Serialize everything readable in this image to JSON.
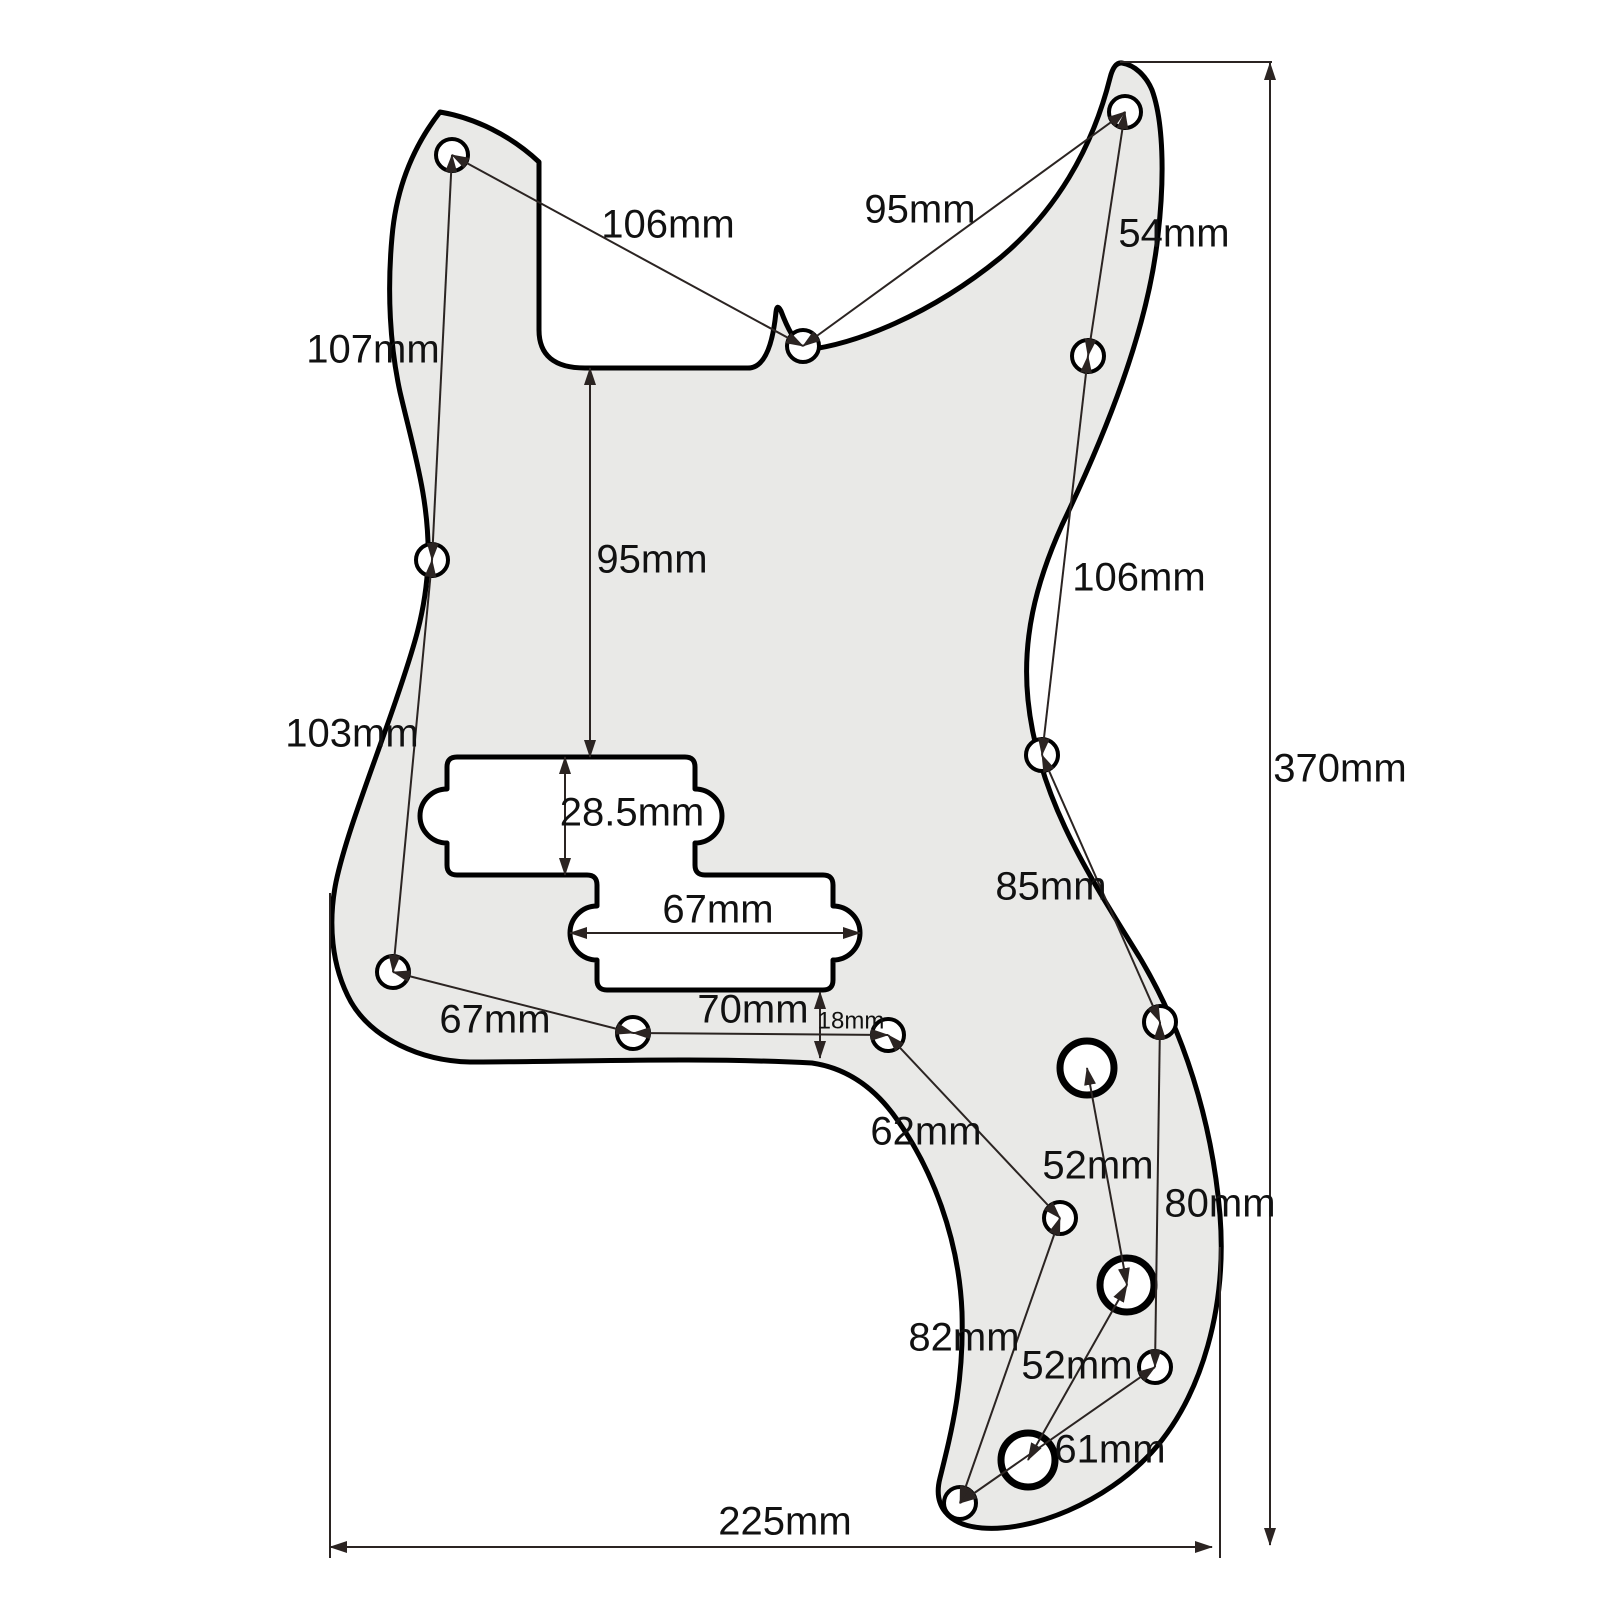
{
  "diagram": {
    "description": "P-Bass pickguard dimension drawing",
    "canvas": {
      "width": 1600,
      "height": 1600,
      "background": "#ffffff"
    },
    "colors": {
      "outline": "#000000",
      "pickguard_fill": "#e9e9e7",
      "cutout_fill": "#ffffff",
      "dimension_line": "#2b2422",
      "label_text": "#111111"
    },
    "pickguard_path": "M 440 112 C 475 118 510 135 539 162 L 539 330 Q 539 368 585 368 L 748 368 C 762 368 772 352 776 312 Q 777 303 781 311 C 787 327 794 342 806 350 C 856 344 930 315 1000 258 C 1055 212 1092 150 1110 78 Q 1114 62 1122 63 C 1135 65 1146 76 1152 90 C 1163 120 1165 175 1158 235 C 1148 330 1105 435 1062 525 C 1035 585 1022 640 1028 700 C 1038 800 1092 880 1140 958 C 1183 1030 1212 1120 1220 1215 C 1227 1305 1203 1395 1152 1452 C 1105 1503 1032 1532 982 1528 C 947 1525 933 1505 940 1478 C 952 1430 964 1382 962 1312 C 959 1240 933 1168 893 1114 C 872 1086 846 1068 812 1063 C 700 1057 565 1062 470 1062 C 420 1061 372 1038 351 1002 C 331 966 328 922 336 882 C 346 835 372 770 396 700 C 413 650 426 612 428 562 C 430 502 414 452 400 392 C 390 346 387 292 392 237 C 396 190 412 148 440 112 Z",
    "pickup_cutout_path": "M 457 757 L 685 757 Q 695 757 695 767 L 695 789 A 27 27 0 0 1 695 843 L 695 865 Q 695 875 705 875 L 823 875 Q 833 875 833 885 L 833 906 A 27 27 0 0 1 833 960 L 833 980 Q 833 990 823 990 L 607 990 Q 597 990 597 980 L 597 960 A 27 27 0 0 1 597 906 L 597 885 Q 597 875 587 875 L 457 875 Q 447 875 447 865 L 447 843 A 27 27 0 0 1 447 789 L 447 767 Q 447 757 457 757 Z",
    "screw_holes": [
      {
        "x": 452,
        "y": 155
      },
      {
        "x": 803,
        "y": 346
      },
      {
        "x": 1125,
        "y": 112
      },
      {
        "x": 1088,
        "y": 356
      },
      {
        "x": 432,
        "y": 560
      },
      {
        "x": 1042,
        "y": 755
      },
      {
        "x": 393,
        "y": 972
      },
      {
        "x": 633,
        "y": 1033
      },
      {
        "x": 888,
        "y": 1035
      },
      {
        "x": 1160,
        "y": 1022
      },
      {
        "x": 1060,
        "y": 1218
      },
      {
        "x": 1155,
        "y": 1367
      },
      {
        "x": 960,
        "y": 1503
      }
    ],
    "pot_holes": [
      {
        "x": 1087,
        "y": 1068
      },
      {
        "x": 1127,
        "y": 1285
      },
      {
        "x": 1028,
        "y": 1460
      }
    ],
    "extension_lines": [
      {
        "x1": 1120,
        "y1": 62,
        "x2": 1272,
        "y2": 62
      },
      {
        "x1": 330,
        "y1": 893,
        "x2": 330,
        "y2": 1558
      },
      {
        "x1": 1220,
        "y1": 1247,
        "x2": 1220,
        "y2": 1558
      }
    ],
    "dimensions": [
      {
        "label": "106mm",
        "x1": 452,
        "y1": 155,
        "x2": 803,
        "y2": 346,
        "lx": 668,
        "ly": 227,
        "size": 40
      },
      {
        "label": "95mm",
        "x1": 803,
        "y1": 346,
        "x2": 1125,
        "y2": 112,
        "lx": 920,
        "ly": 212,
        "size": 40
      },
      {
        "label": "54mm",
        "x1": 1125,
        "y1": 112,
        "x2": 1088,
        "y2": 356,
        "lx": 1174,
        "ly": 236,
        "size": 40
      },
      {
        "label": "107mm",
        "x1": 452,
        "y1": 155,
        "x2": 432,
        "y2": 560,
        "lx": 373,
        "ly": 352,
        "size": 40
      },
      {
        "label": "95mm",
        "x1": 590,
        "y1": 368,
        "x2": 590,
        "y2": 757,
        "lx": 652,
        "ly": 562,
        "size": 40
      },
      {
        "label": "106mm",
        "x1": 1088,
        "y1": 356,
        "x2": 1042,
        "y2": 755,
        "lx": 1139,
        "ly": 580,
        "size": 40
      },
      {
        "label": "103mm",
        "x1": 432,
        "y1": 560,
        "x2": 393,
        "y2": 972,
        "lx": 352,
        "ly": 736,
        "size": 40
      },
      {
        "label": "28.5mm",
        "x1": 565,
        "y1": 757,
        "x2": 565,
        "y2": 875,
        "lx": 632,
        "ly": 815,
        "size": 40
      },
      {
        "label": "67mm",
        "x1": 570,
        "y1": 933,
        "x2": 860,
        "y2": 933,
        "lx": 718,
        "ly": 912,
        "size": 40
      },
      {
        "label": "85mm",
        "x1": 1042,
        "y1": 755,
        "x2": 1160,
        "y2": 1022,
        "lx": 1051,
        "ly": 889,
        "size": 40
      },
      {
        "label": "67mm",
        "x1": 393,
        "y1": 972,
        "x2": 633,
        "y2": 1033,
        "lx": 495,
        "ly": 1022,
        "size": 40
      },
      {
        "label": "70mm",
        "x1": 633,
        "y1": 1033,
        "x2": 888,
        "y2": 1035,
        "lx": 753,
        "ly": 1012,
        "size": 40
      },
      {
        "label": "18mm",
        "x1": 820,
        "y1": 992,
        "x2": 820,
        "y2": 1058,
        "lx": 851,
        "ly": 1022,
        "size": 24
      },
      {
        "label": "62mm",
        "x1": 888,
        "y1": 1035,
        "x2": 1060,
        "y2": 1218,
        "lx": 926,
        "ly": 1134,
        "size": 40
      },
      {
        "label": "52mm",
        "x1": 1087,
        "y1": 1068,
        "x2": 1127,
        "y2": 1285,
        "lx": 1098,
        "ly": 1168,
        "size": 40
      },
      {
        "label": "80mm",
        "x1": 1160,
        "y1": 1022,
        "x2": 1155,
        "y2": 1367,
        "lx": 1220,
        "ly": 1206,
        "size": 40
      },
      {
        "label": "82mm",
        "x1": 1060,
        "y1": 1218,
        "x2": 960,
        "y2": 1503,
        "lx": 964,
        "ly": 1340,
        "size": 40
      },
      {
        "label": "52mm",
        "x1": 1127,
        "y1": 1285,
        "x2": 1028,
        "y2": 1460,
        "lx": 1077,
        "ly": 1368,
        "size": 40
      },
      {
        "label": "61mm",
        "x1": 960,
        "y1": 1503,
        "x2": 1155,
        "y2": 1367,
        "lx": 1110,
        "ly": 1452,
        "size": 40
      },
      {
        "label": "370mm",
        "x1": 1270,
        "y1": 63,
        "x2": 1270,
        "y2": 1545,
        "lx": 1340,
        "ly": 771,
        "size": 40
      },
      {
        "label": "225mm",
        "x1": 330,
        "y1": 1547,
        "x2": 1212,
        "y2": 1547,
        "lx": 785,
        "ly": 1524,
        "size": 40
      }
    ]
  }
}
